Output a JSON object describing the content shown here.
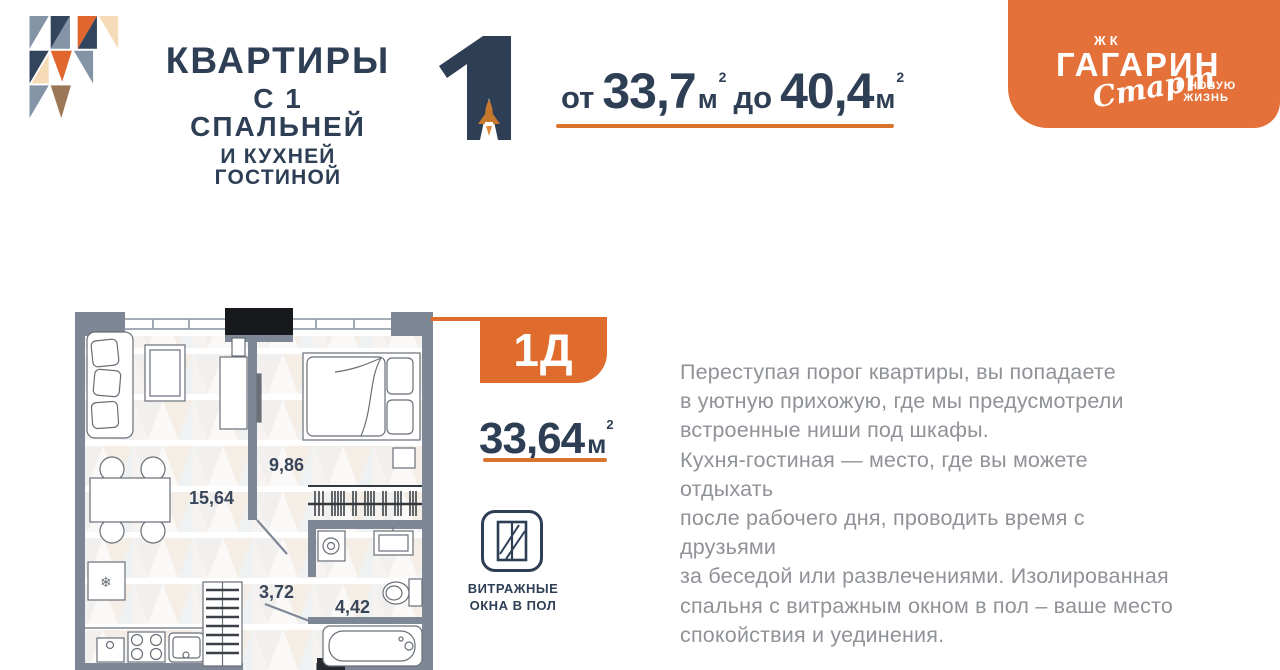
{
  "header": {
    "title_line1": "КВАРТИРЫ",
    "title_line2": "С 1 СПАЛЬНЕЙ",
    "title_line3": "И КУХНЕЙ ГОСТИНОЙ",
    "bedroom_count": "1",
    "range": {
      "prefix": "от",
      "min": "33,7",
      "mid": "до",
      "max": "40,4",
      "unit": "м",
      "sup": "2"
    },
    "brand": {
      "complex_type": "ЖК",
      "name": "ГАГАРИН",
      "script_word": "Старт",
      "tagline_line1": "В НОВУЮ",
      "tagline_line2": "ЖИЗНЬ"
    }
  },
  "plan": {
    "unit_label": "1Д",
    "area_value": "33,64",
    "area_unit": "м",
    "area_sup": "2",
    "rooms": [
      {
        "name": "кухня-гостиная",
        "area": "15,64"
      },
      {
        "name": "спальня",
        "area": "9,86"
      },
      {
        "name": "прихожая",
        "area": "3,72"
      },
      {
        "name": "санузел",
        "area": "4,42"
      }
    ],
    "feature": {
      "icon": "panoramic-window-icon",
      "label_line1": "ВИТРАЖНЫЕ",
      "label_line2": "ОКНА В ПОЛ"
    }
  },
  "description": "Переступая порог квартиры, вы попадаете\nв уютную прихожую, где мы предусмотрели\nвстроенные ниши под шкафы.\nКухня-гостиная — место, где вы можете отдыхать\nпосле рабочего дня, проводить время с друзьями\nза беседой или развлечениями. Изолированная\nспальня с витражным окном в пол – ваше место\nспокойствия и уединения.",
  "colors": {
    "navy": "#2E3F55",
    "accent_orange": "#DF6B2D",
    "brand_orange": "#E5713A",
    "wall_gray": "#7D8795",
    "text_gray": "#8F9297"
  }
}
